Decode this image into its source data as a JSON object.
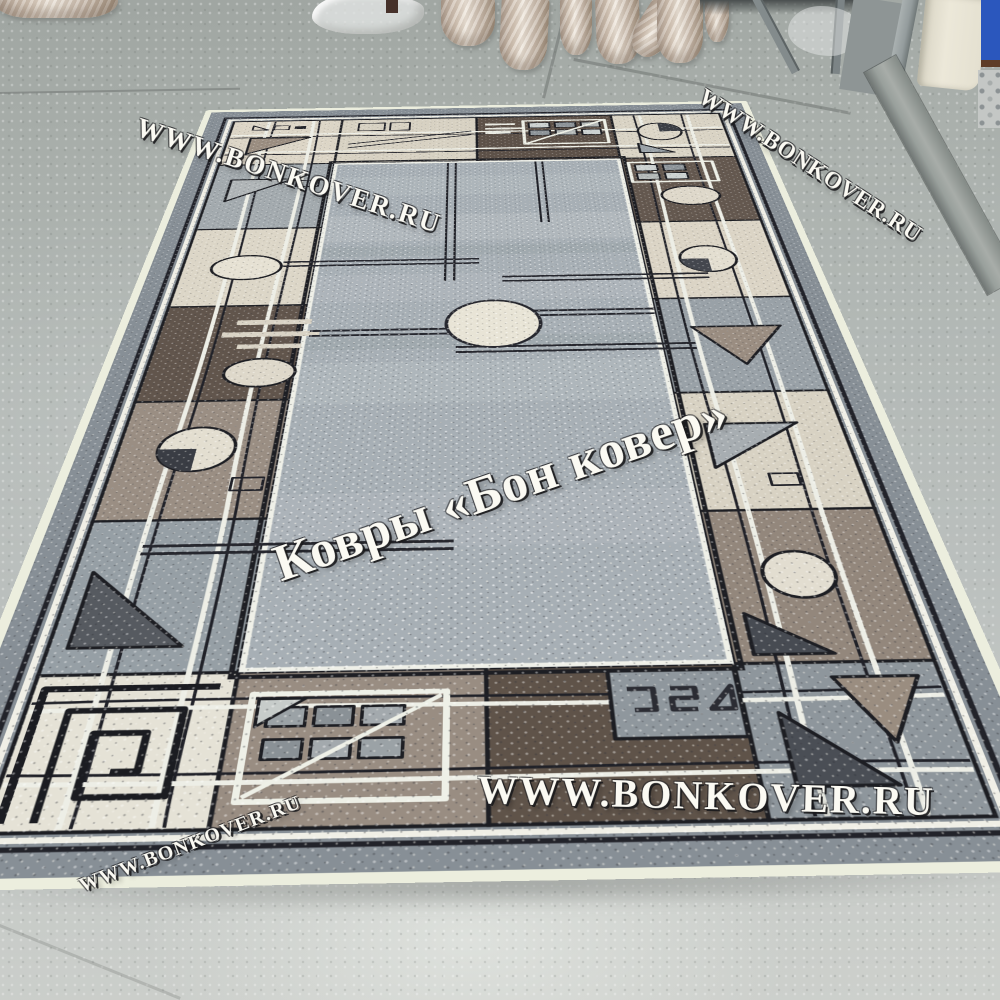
{
  "image_type": "product-photo",
  "scene": {
    "subject": "Geometric patchwork rug lying on a painted concrete showroom floor",
    "background": "Wrapped carpet rolls in shiny plastic, a plastic bag, a doorway with cream frame and blue door, a metal threshold strip"
  },
  "watermarks": {
    "top_left": "WWW.BONKOVER.RU",
    "top_right": "WWW.BONKOVER.RU",
    "center": "Ковры «Бон ковер»",
    "bottom_center": "WWW.BONKOVER.RU",
    "bottom_left": "WWW.BONKOVER.RU"
  },
  "colors": {
    "floor": "#b3b8b6",
    "floor_light": "#cdd0cc",
    "rug_field": "#a7afb5",
    "rug_outer_band": "#878f96",
    "border_cream": "#dad3c4",
    "border_brown": "#5f5349",
    "border_taupe": "#998d82",
    "border_gray": "#98a0a6",
    "outline_black": "#1d1e23",
    "outline_white": "#efefe7",
    "roll_wrap": "#d6c8b9",
    "door_blue": "#2b57bd",
    "door_frame_cream": "#e9e5d6",
    "metal_strip": "#99a09c"
  }
}
